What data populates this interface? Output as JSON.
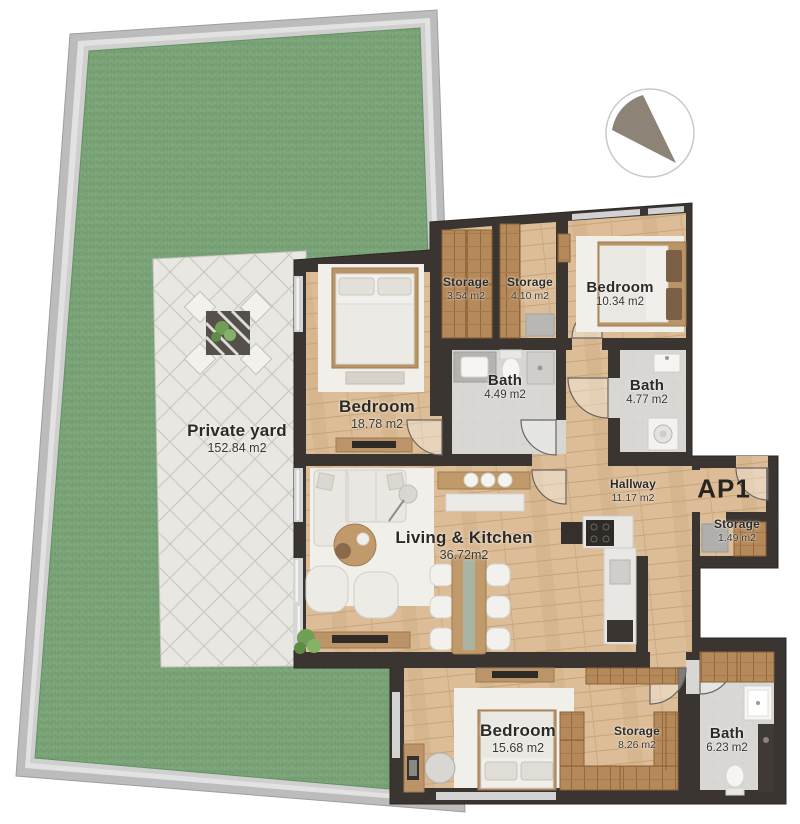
{
  "plan": {
    "unit_label": "AP1",
    "north_indicator": "sector-compass",
    "rooms": [
      {
        "id": "private-yard",
        "name": "Private yard",
        "area": "152.84 m2"
      },
      {
        "id": "bedroom-1",
        "name": "Bedroom",
        "area": "18.78 m2"
      },
      {
        "id": "storage-1",
        "name": "Storage",
        "area": "3.54 m2"
      },
      {
        "id": "storage-2",
        "name": "Storage",
        "area": "4.10 m2"
      },
      {
        "id": "bedroom-2",
        "name": "Bedroom",
        "area": "10.34 m2"
      },
      {
        "id": "bath-1",
        "name": "Bath",
        "area": "4.49 m2"
      },
      {
        "id": "bath-2",
        "name": "Bath",
        "area": "4.77 m2"
      },
      {
        "id": "hallway",
        "name": "Hallway",
        "area": "11.17 m2"
      },
      {
        "id": "storage-3",
        "name": "Storage",
        "area": "1.49 m2"
      },
      {
        "id": "living-kitchen",
        "name": "Living & Kitchen",
        "area": "36.72m2"
      },
      {
        "id": "bedroom-3",
        "name": "Bedroom",
        "area": "15.68 m2"
      },
      {
        "id": "storage-4",
        "name": "Storage",
        "area": "8.26 m2"
      },
      {
        "id": "bath-3",
        "name": "Bath",
        "area": "6.23 m2"
      }
    ],
    "colors": {
      "wall": "#3a3531",
      "wood_floor": "#dcbd97",
      "closet_wood": "#b5895a",
      "bath_floor": "#d8d7d4",
      "grass": "#79a377",
      "patio": "#e9e7e2",
      "fence": "#c2c2c2",
      "rug": "#f1efe9",
      "north_wedge": "#8d8477",
      "label_text": "#2d2a26"
    }
  }
}
